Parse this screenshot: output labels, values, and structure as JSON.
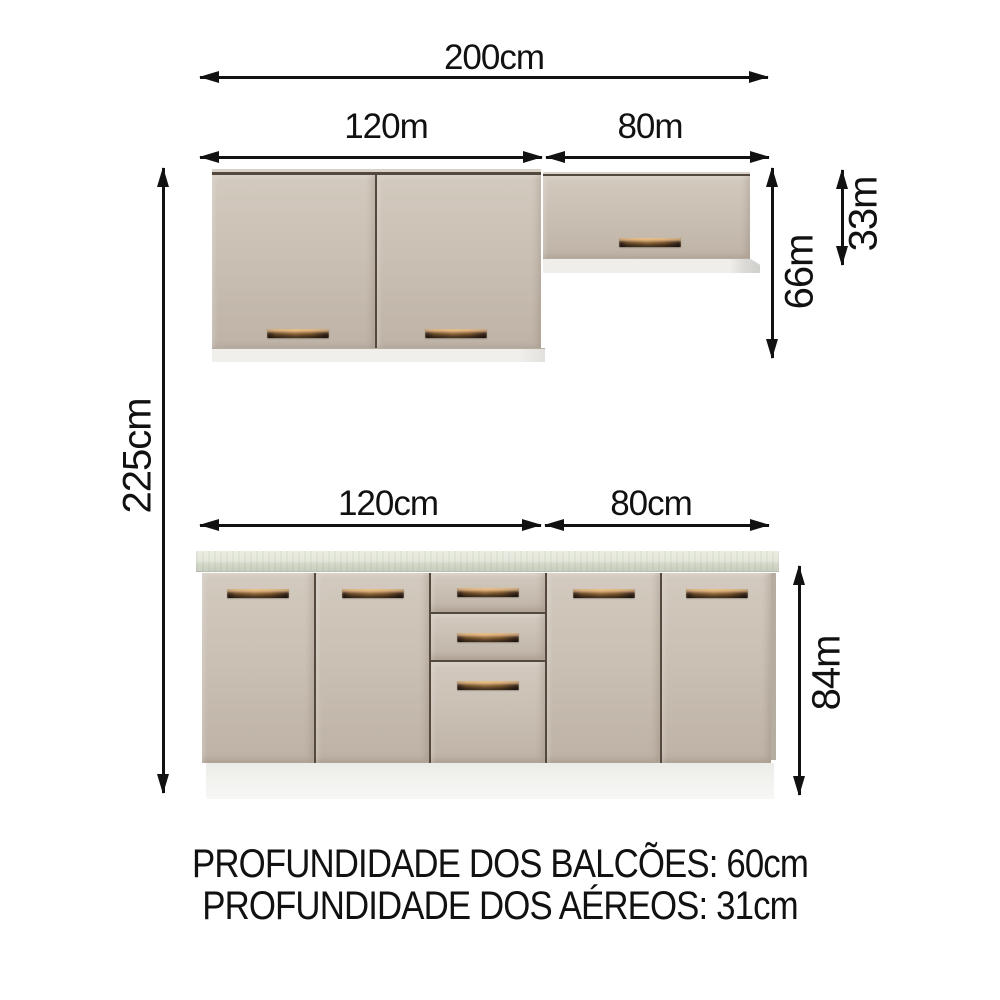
{
  "diagram": {
    "dimensions": {
      "total_width": "200cm",
      "wall_left_width": "120m",
      "wall_right_width": "80m",
      "total_height": "225cm",
      "wall_tall_height": "66m",
      "wall_short_height": "33m",
      "base_left_width": "120cm",
      "base_right_width": "80cm",
      "base_height": "84m"
    },
    "notes": {
      "line1": "PROFUNDIDADE DOS BALCÕES: 60cm",
      "line2": "PROFUNDIDADE DOS AÉREOS: 31cm"
    },
    "colors": {
      "background": "#ffffff",
      "arrow": "#111111",
      "door_face": "#cac0b4",
      "door_face_light": "#d3cabf",
      "door_face_dark": "#bdb2a5",
      "panel_gap": "#55493d",
      "cabinet_underside": "#f0efec",
      "countertop_top": "#e3e6da",
      "countertop_front": "#c9cfc0",
      "plinth": "#f2f2ef",
      "side_panel": "#b6ada1",
      "handle_copper": "#a97c49",
      "handle_dark": "#35241f"
    }
  }
}
